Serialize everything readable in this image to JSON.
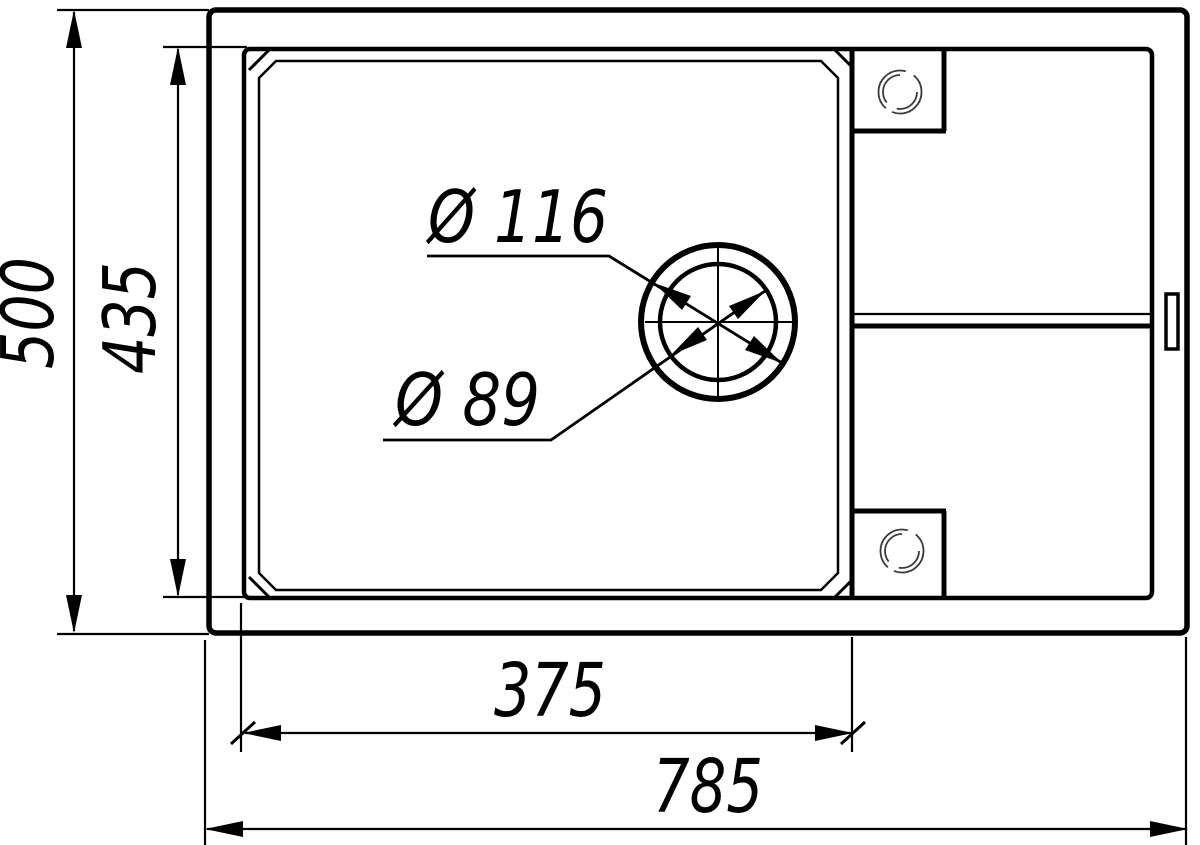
{
  "diagram": {
    "type": "technical-drawing",
    "subject": "Kitchen sink with drainboard - top view dimensional drawing",
    "units": "mm",
    "dimensions": [
      {
        "id": "overall-height",
        "value": "500"
      },
      {
        "id": "bowl-height",
        "value": "435"
      },
      {
        "id": "bowl-width",
        "value": "375"
      },
      {
        "id": "overall-width",
        "value": "785"
      },
      {
        "id": "drain-outer-diameter",
        "value": "Ø 116"
      },
      {
        "id": "drain-inner-diameter",
        "value": "Ø 89"
      }
    ],
    "colors": {
      "line": "#000000",
      "background": "#ffffff",
      "hole_detail": "#3a3a3a"
    }
  }
}
